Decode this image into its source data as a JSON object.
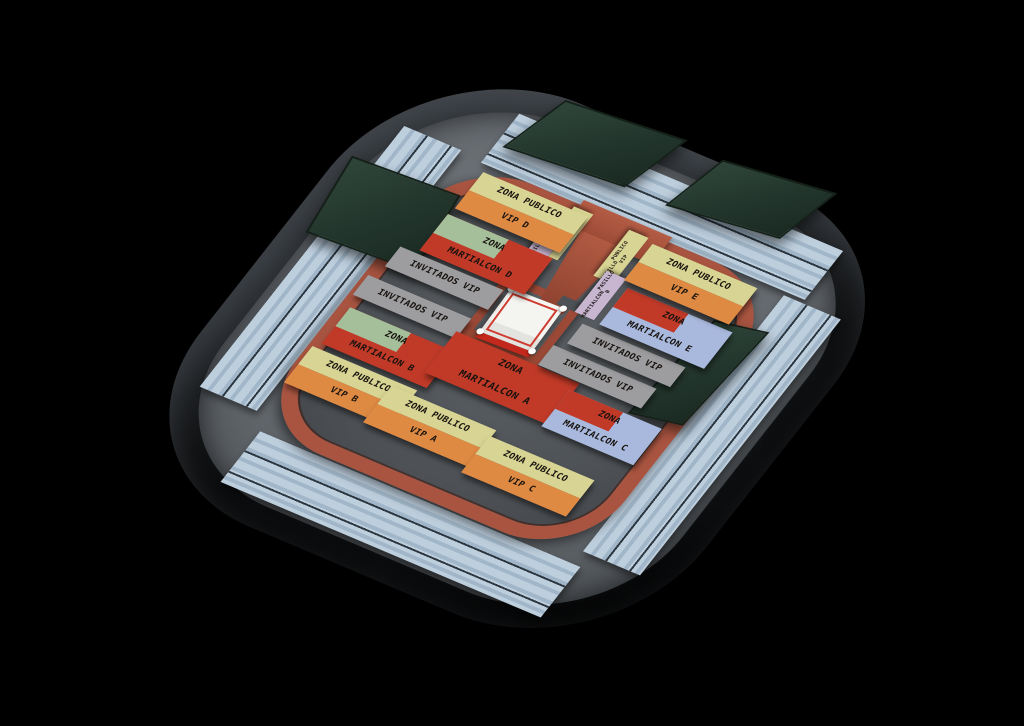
{
  "scene": {
    "description": "3D rendered seating map of an indoor arena for a MartialCon martial-arts event, with a central wrestling ring, copper perimeter fence, light-blue grandstands and dark green video screens",
    "background": "#000000"
  },
  "palette": {
    "public_header_yellow": "#d8d493",
    "public_body_orange": "#de8a43",
    "martialcon_red": "#c13a28",
    "martialcon_green": "#a4bf99",
    "martialcon_blue": "#a9b9dd",
    "invitados_gray": "#9d9d9f",
    "aisle_tag_lilac": "#c8b5d0",
    "stand_blue": "#b7c9d9",
    "fence_copper": "#a85440",
    "screen_green": "#27392e",
    "arena_floor": "#54585c",
    "ring_canvas": "#f2f2ef",
    "ring_apron_red": "#c3281c"
  },
  "zones": [
    {
      "id": "vip-d",
      "line1": "ZONA PUBLICO",
      "line2": "VIP D"
    },
    {
      "id": "martialcon-d",
      "line1": "ZONA",
      "line2": "MARTIALCON D"
    },
    {
      "id": "invitados-nw-upper",
      "line1": "INVITADOS VIP"
    },
    {
      "id": "invitados-nw-lower",
      "line1": "INVITADOS VIP"
    },
    {
      "id": "martialcon-b",
      "line1": "ZONA",
      "line2": "MARTIALCON B"
    },
    {
      "id": "vip-b",
      "line1": "ZONA PUBLICO",
      "line2": "VIP B"
    },
    {
      "id": "vip-a",
      "line1": "ZONA PUBLICO",
      "line2": "VIP A"
    },
    {
      "id": "martialcon-a",
      "line1": "ZONA",
      "line2": "MARTIALCON A"
    },
    {
      "id": "vip-c",
      "line1": "ZONA PUBLICO",
      "line2": "VIP C"
    },
    {
      "id": "martialcon-c",
      "line1": "ZONA",
      "line2": "MARTIALCON C"
    },
    {
      "id": "invitados-se",
      "line1": "INVITADOS VIP"
    },
    {
      "id": "invitados-e",
      "line1": "INVITADOS VIP"
    },
    {
      "id": "martialcon-e",
      "line1": "ZONA",
      "line2": "MARTIALCON E"
    },
    {
      "id": "vip-e",
      "line1": "ZONA PUBLICO",
      "line2": "VIP E"
    }
  ],
  "aisle_tags": [
    {
      "id": "pasillo-publico-vip-west",
      "line1": "PASILLO",
      "line2": "PUBLICO VIP"
    },
    {
      "id": "martialcon-pasillo-a",
      "line1": "MARTIALCON",
      "line2": "PASILLO A"
    },
    {
      "id": "pasillo-publico-vip-east",
      "line1": "PASILLO",
      "line2": "PUBLICO VIP"
    },
    {
      "id": "martialcon-pasillo-b",
      "line1": "MARTIALCON",
      "line2": "PASILLO B"
    }
  ],
  "structures": {
    "wrestling_ring": 1,
    "video_screens": 4,
    "grandstands": 4,
    "entrance_ramp": 1
  }
}
